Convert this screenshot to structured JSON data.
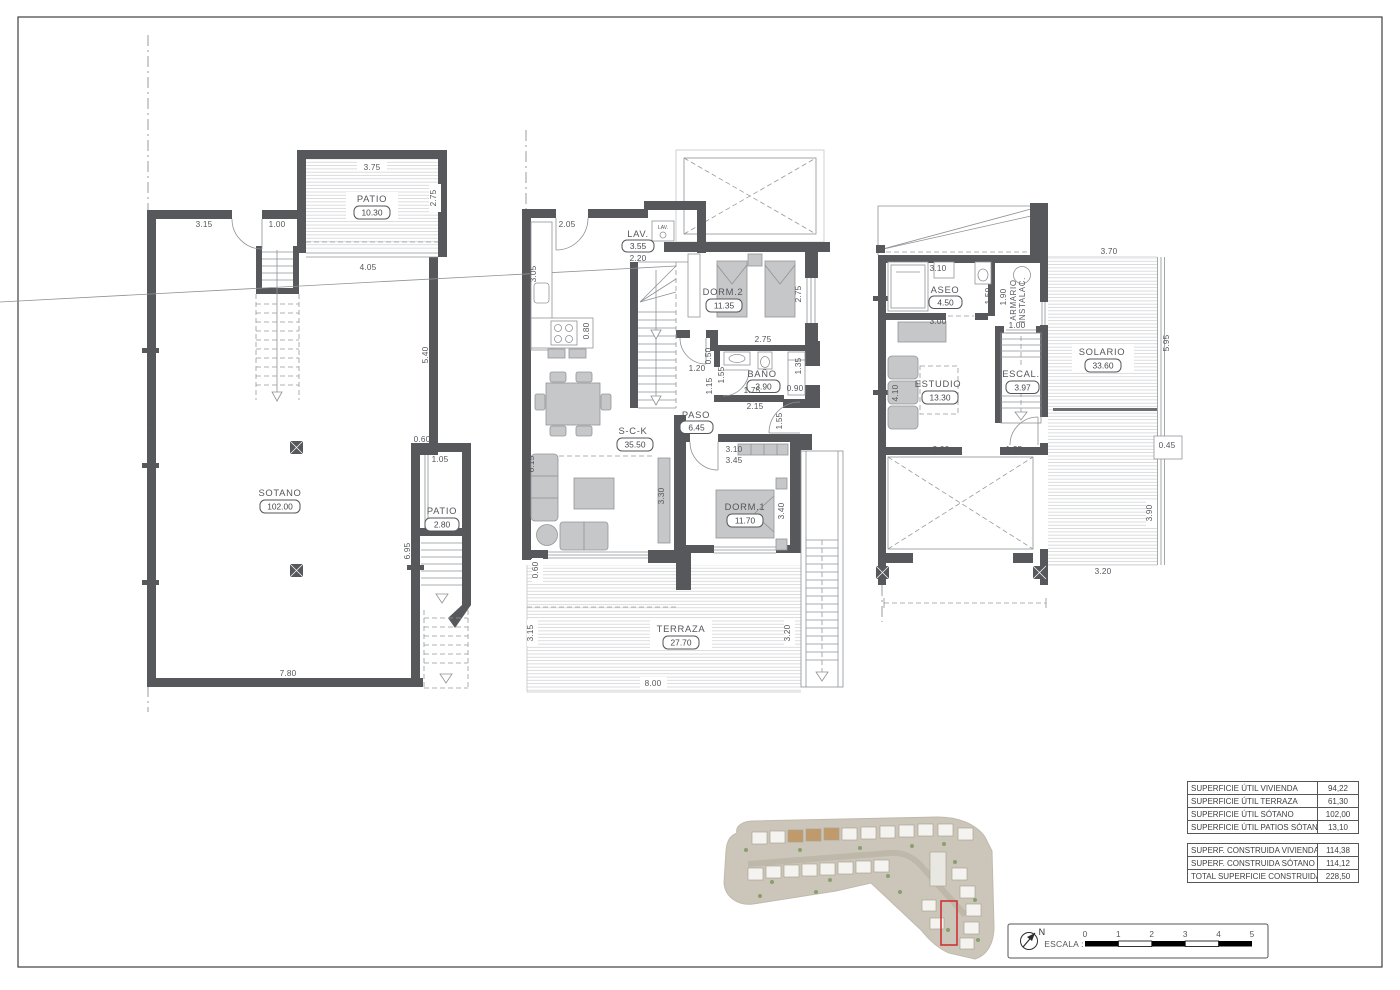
{
  "drawing": {
    "frame_color": "#3f4042",
    "wall_color": "#57585b"
  },
  "plans": {
    "sotano": {
      "rooms": [
        {
          "name": "SOTANO",
          "area": "102.00"
        },
        {
          "name": "PATIO",
          "area": "10.30"
        },
        {
          "name": "PATIO",
          "area": "2.80"
        }
      ],
      "dims": [
        "3.75",
        "2.75",
        "3.15",
        "1.00",
        "4.05",
        "5.40",
        "13.75",
        "0.60",
        "1.05",
        "6.95",
        "7.80"
      ]
    },
    "planta_baja": {
      "rooms": [
        {
          "name": "LAV.",
          "area": "3.55"
        },
        {
          "name": "DORM.2",
          "area": "11.35"
        },
        {
          "name": "BAÑO",
          "area": "3.90"
        },
        {
          "name": "PASO",
          "area": "6.45"
        },
        {
          "name": "S-C-K",
          "area": "35.50"
        },
        {
          "name": "DORM.1",
          "area": "11.70"
        },
        {
          "name": "TERRAZA",
          "area": "27.70"
        }
      ],
      "appliance_label": "LAV.",
      "dims": [
        "2.05",
        "3.05",
        "0.80",
        "2.20",
        "2.75",
        "2.75",
        "0.50",
        "1.55",
        "1.15",
        "0.90",
        "1.35",
        "1.75",
        "2.15",
        "1.20",
        "1.55",
        "6.15",
        "3.30",
        "3.10",
        "3.45",
        "3.40",
        "0.60",
        "3.15",
        "3.20",
        "8.00"
      ]
    },
    "planta_alta": {
      "rooms": [
        {
          "name": "ASEO",
          "area": "4.50"
        },
        {
          "name": "ESTUDIO",
          "area": "13.30"
        },
        {
          "name": "ESCAL.",
          "area": "3.97"
        },
        {
          "name": "SOLARIO",
          "area": "33.60"
        }
      ],
      "closet_label_line1": "ARMARIO",
      "closet_label_line2": "INSTALAC.",
      "dims": [
        "3.10",
        "1.50",
        "1.90",
        "1.00",
        "3.00",
        "4.10",
        "3.70",
        "5.95",
        "0.45",
        "3.00",
        "1.35",
        "3.90",
        "3.20"
      ]
    }
  },
  "summary": {
    "useful": [
      {
        "label": "SUPERFICIE ÚTIL VIVIENDA",
        "value": "94,22"
      },
      {
        "label": "SUPERFICIE ÚTIL TERRAZA",
        "value": "61,30"
      },
      {
        "label": "SUPERFICIE ÚTIL SÓTANO",
        "value": "102,00"
      },
      {
        "label": "SUPERFICIE ÚTIL PATIOS SÓTANO",
        "value": "13,10"
      }
    ],
    "built": [
      {
        "label": "SUPERF. CONSTRUIDA VIVIENDA",
        "value": "114,38"
      },
      {
        "label": "SUPERF. CONSTRUIDA SÓTANO",
        "value": "114,12"
      },
      {
        "label": "TOTAL SUPERFICIE CONSTRUIDA",
        "value": "228,50"
      }
    ]
  },
  "scale_bar": {
    "label": "ESCALA :",
    "ticks": [
      "0",
      "1",
      "2",
      "3",
      "4",
      "5"
    ]
  },
  "compass": {
    "label": "N"
  },
  "site_plan": {
    "highlight_color": "#cf3333"
  }
}
